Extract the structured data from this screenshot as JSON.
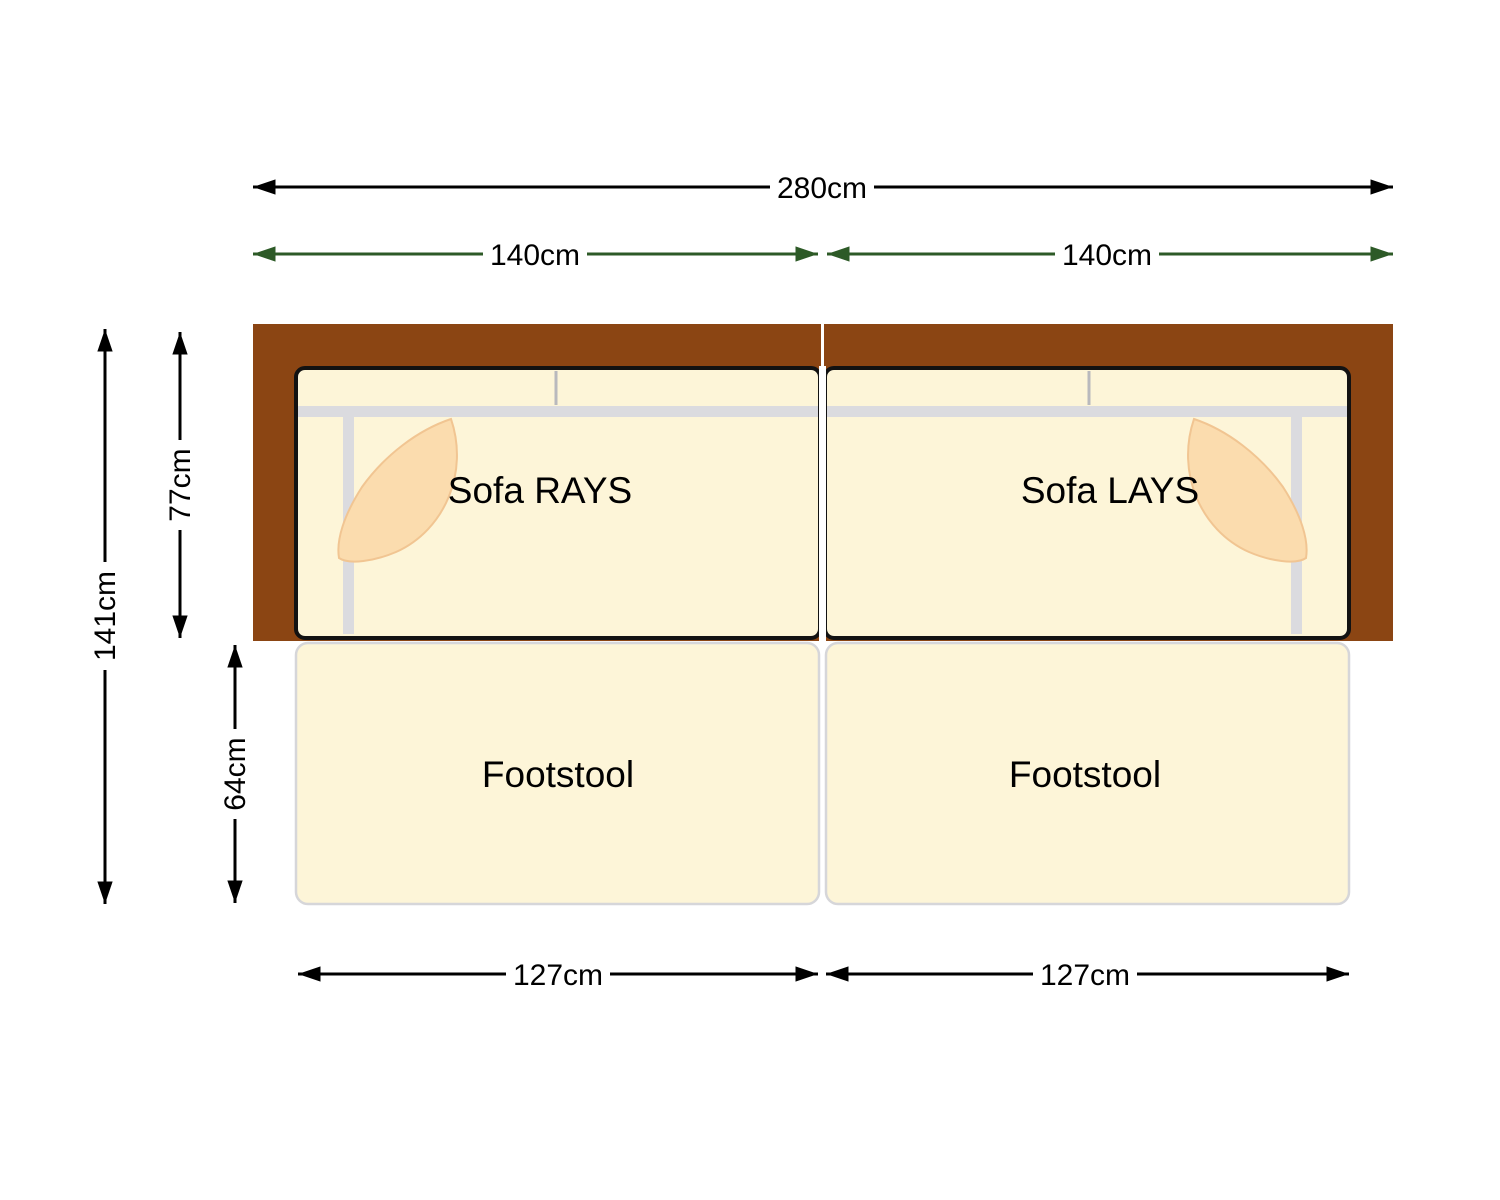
{
  "diagram": {
    "type": "sofa-floorplan-dimension-diagram",
    "background": "#FFFFFF"
  },
  "colors": {
    "frame_wood": "#8B4513",
    "cushion_cream": "#FDF5D8",
    "cushion_outline": "#121212",
    "seam_gray": "#DBDBDF",
    "back_split_gray": "#B9B9BD",
    "pillow_fill": "#FBDCAE",
    "pillow_edge": "#F1C592",
    "footstool_fill": "#FDF5D8",
    "footstool_border": "#D6D6D9",
    "dimension_black": "#000000",
    "dimension_green": "#2D5A27",
    "divider_white": "#FFFFFF",
    "label_text": "#000000"
  },
  "dimensions": {
    "total_width": "280cm",
    "sofa_left_width": "140cm",
    "sofa_right_width": "140cm",
    "total_depth": "141cm",
    "sofa_depth": "77cm",
    "footstool_depth": "64cm",
    "footstool_left_width": "127cm",
    "footstool_right_width": "127cm"
  },
  "items": {
    "sofa_left_label": "Sofa RAYS",
    "sofa_right_label": "Sofa LAYS",
    "footstool_left_label": "Footstool",
    "footstool_right_label": "Footstool"
  }
}
